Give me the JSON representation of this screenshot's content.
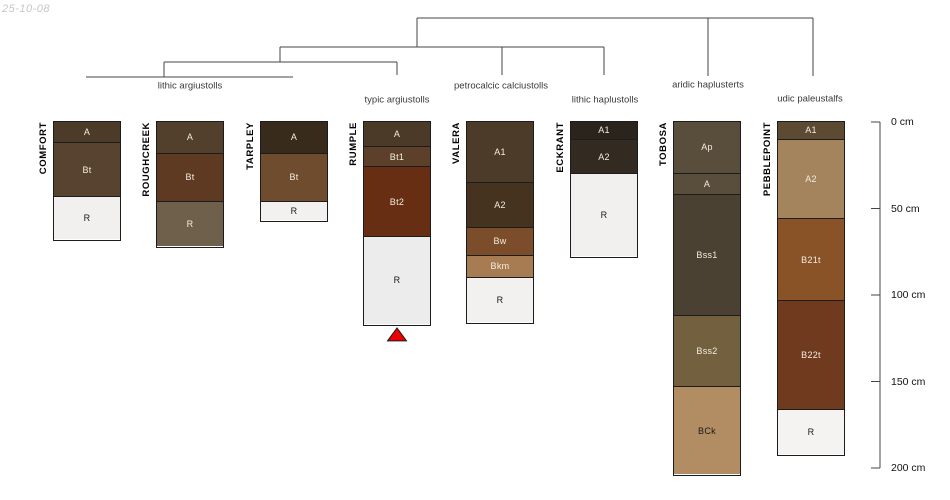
{
  "date_stamp": "25-10-08",
  "colors": {
    "background": "#ffffff",
    "tree_line": "#454545",
    "axis_line": "#454545",
    "box_border": "#1c1c1c",
    "horizon_label_light": "#f3ede2",
    "horizon_label_dark": "#1a1a1a",
    "class_label_color": "#3a3a3a",
    "depth_label_color": "#111111",
    "date_color": "#c7c7c7",
    "marker_fill": "#ee0000",
    "marker_stroke": "#1a1a1a"
  },
  "chart_data": {
    "type": "soil-profile-dendrogram",
    "description": "Depth diagram of eight soil series profiles grouped by taxonomic class with a cluster tree above and a depth scale at right",
    "depth_axis": {
      "unit": "cm",
      "min_cm": 0,
      "max_cm": 200,
      "ticks": [
        {
          "cm": 0,
          "label": "0 cm"
        },
        {
          "cm": 50,
          "label": "50 cm"
        },
        {
          "cm": 100,
          "label": "100 cm"
        },
        {
          "cm": 150,
          "label": "150 cm"
        },
        {
          "cm": 200,
          "label": "200 cm"
        }
      ]
    },
    "classes": [
      {
        "label": "lithic argiustolls",
        "cx": 190,
        "cy": 86,
        "profiles": [
          "COMFORT",
          "ROUGHCREEK",
          "TARPLEY"
        ]
      },
      {
        "label": "typic argiustolls",
        "cx": 397,
        "cy": 100,
        "profiles": [
          "RUMPLE"
        ]
      },
      {
        "label": "petrocalcic calciustolls",
        "cx": 501,
        "cy": 86,
        "profiles": [
          "VALERA"
        ]
      },
      {
        "label": "lithic haplustolls",
        "cx": 605,
        "cy": 100,
        "profiles": [
          "ECKRANT"
        ]
      },
      {
        "label": "aridic haplusterts",
        "cx": 708,
        "cy": 85,
        "profiles": [
          "TOBOSA"
        ]
      },
      {
        "label": "udic paleustalfs",
        "cx": 810,
        "cy": 99,
        "profiles": [
          "PEBBLEPOINT"
        ]
      }
    ],
    "profiles": [
      {
        "name": "COMFORT",
        "center_x": 87,
        "horizons": [
          {
            "name": "A",
            "top_cm": 0,
            "bottom_cm": 12,
            "color": "#4d3b29",
            "label_tone": "light"
          },
          {
            "name": "Bt",
            "top_cm": 12,
            "bottom_cm": 43,
            "color": "#57432f",
            "label_tone": "light"
          },
          {
            "name": "R",
            "top_cm": 43,
            "bottom_cm": 68,
            "color": "#f2f0ee",
            "label_tone": "dark"
          }
        ]
      },
      {
        "name": "ROUGHCREEK",
        "center_x": 190,
        "horizons": [
          {
            "name": "A",
            "top_cm": 0,
            "bottom_cm": 18,
            "color": "#52402d",
            "label_tone": "light"
          },
          {
            "name": "Bt",
            "top_cm": 18,
            "bottom_cm": 46,
            "color": "#5e3a23",
            "label_tone": "light"
          },
          {
            "name": "R",
            "top_cm": 46,
            "bottom_cm": 72,
            "color": "#6f604c",
            "label_tone": "light"
          }
        ]
      },
      {
        "name": "TARPLEY",
        "center_x": 294,
        "horizons": [
          {
            "name": "A",
            "top_cm": 0,
            "bottom_cm": 18,
            "color": "#382b1c",
            "label_tone": "light"
          },
          {
            "name": "Bt",
            "top_cm": 18,
            "bottom_cm": 46,
            "color": "#6f4c2d",
            "label_tone": "light"
          },
          {
            "name": "R",
            "top_cm": 46,
            "bottom_cm": 57,
            "color": "#f3f1ef",
            "label_tone": "dark"
          }
        ]
      },
      {
        "name": "RUMPLE",
        "center_x": 397,
        "horizons": [
          {
            "name": "A",
            "top_cm": 0,
            "bottom_cm": 14,
            "color": "#4b3a28",
            "label_tone": "light"
          },
          {
            "name": "Bt1",
            "top_cm": 14,
            "bottom_cm": 26,
            "color": "#5d4029",
            "label_tone": "light"
          },
          {
            "name": "Bt2",
            "top_cm": 26,
            "bottom_cm": 66,
            "color": "#672e13",
            "label_tone": "light"
          },
          {
            "name": "R",
            "top_cm": 66,
            "bottom_cm": 117,
            "color": "#ececec",
            "label_tone": "dark"
          }
        ]
      },
      {
        "name": "VALERA",
        "center_x": 500,
        "horizons": [
          {
            "name": "A1",
            "top_cm": 0,
            "bottom_cm": 35,
            "color": "#4c3b28",
            "label_tone": "light"
          },
          {
            "name": "A2",
            "top_cm": 35,
            "bottom_cm": 61,
            "color": "#46331f",
            "label_tone": "light"
          },
          {
            "name": "Bw",
            "top_cm": 61,
            "bottom_cm": 77,
            "color": "#7b4d2a",
            "label_tone": "light"
          },
          {
            "name": "Bkm",
            "top_cm": 77,
            "bottom_cm": 90,
            "color": "#a87c52",
            "label_tone": "light"
          },
          {
            "name": "R",
            "top_cm": 90,
            "bottom_cm": 116,
            "color": "#f2f1ef",
            "label_tone": "dark"
          }
        ]
      },
      {
        "name": "ECKRANT",
        "center_x": 604,
        "horizons": [
          {
            "name": "A1",
            "top_cm": 0,
            "bottom_cm": 10,
            "color": "#2b241d",
            "label_tone": "light"
          },
          {
            "name": "A2",
            "top_cm": 10,
            "bottom_cm": 30,
            "color": "#332a21",
            "label_tone": "light"
          },
          {
            "name": "R",
            "top_cm": 30,
            "bottom_cm": 78,
            "color": "#f1f0ee",
            "label_tone": "dark"
          }
        ]
      },
      {
        "name": "TOBOSA",
        "center_x": 707,
        "horizons": [
          {
            "name": "Ap",
            "top_cm": 0,
            "bottom_cm": 30,
            "color": "#594e3c",
            "label_tone": "light"
          },
          {
            "name": "A",
            "top_cm": 30,
            "bottom_cm": 42,
            "color": "#594e3c",
            "label_tone": "light"
          },
          {
            "name": "Bss1",
            "top_cm": 42,
            "bottom_cm": 112,
            "color": "#4a4133",
            "label_tone": "light"
          },
          {
            "name": "Bss2",
            "top_cm": 112,
            "bottom_cm": 153,
            "color": "#73603f",
            "label_tone": "light"
          },
          {
            "name": "BCk",
            "top_cm": 153,
            "bottom_cm": 204,
            "color": "#b28c63",
            "label_tone": "dark"
          }
        ]
      },
      {
        "name": "PEBBLEPOINT",
        "center_x": 811,
        "horizons": [
          {
            "name": "A1",
            "top_cm": 0,
            "bottom_cm": 10,
            "color": "#5c4a33",
            "label_tone": "light"
          },
          {
            "name": "A2",
            "top_cm": 10,
            "bottom_cm": 56,
            "color": "#a3845c",
            "label_tone": "light"
          },
          {
            "name": "B21t",
            "top_cm": 56,
            "bottom_cm": 103,
            "color": "#8a5227",
            "label_tone": "light"
          },
          {
            "name": "B22t",
            "top_cm": 103,
            "bottom_cm": 166,
            "color": "#6f3a1e",
            "label_tone": "light"
          },
          {
            "name": "R",
            "top_cm": 166,
            "bottom_cm": 192,
            "color": "#f4f3f1",
            "label_tone": "dark"
          }
        ]
      }
    ],
    "dendrogram_segments": [
      {
        "x1": 417,
        "y1": 18,
        "x2": 813,
        "y2": 18
      },
      {
        "x1": 417,
        "y1": 18,
        "x2": 417,
        "y2": 47
      },
      {
        "x1": 708,
        "y1": 18,
        "x2": 708,
        "y2": 76
      },
      {
        "x1": 813,
        "y1": 18,
        "x2": 813,
        "y2": 76
      },
      {
        "x1": 280,
        "y1": 47,
        "x2": 604,
        "y2": 47
      },
      {
        "x1": 280,
        "y1": 47,
        "x2": 280,
        "y2": 62
      },
      {
        "x1": 502,
        "y1": 47,
        "x2": 502,
        "y2": 75
      },
      {
        "x1": 604,
        "y1": 47,
        "x2": 604,
        "y2": 75
      },
      {
        "x1": 164,
        "y1": 62,
        "x2": 397,
        "y2": 62
      },
      {
        "x1": 164,
        "y1": 62,
        "x2": 164,
        "y2": 77
      },
      {
        "x1": 397,
        "y1": 62,
        "x2": 397,
        "y2": 75
      },
      {
        "x1": 86,
        "y1": 77,
        "x2": 293,
        "y2": 77
      }
    ],
    "marker": {
      "profile": "RUMPLE",
      "shape": "triangle-up"
    }
  }
}
